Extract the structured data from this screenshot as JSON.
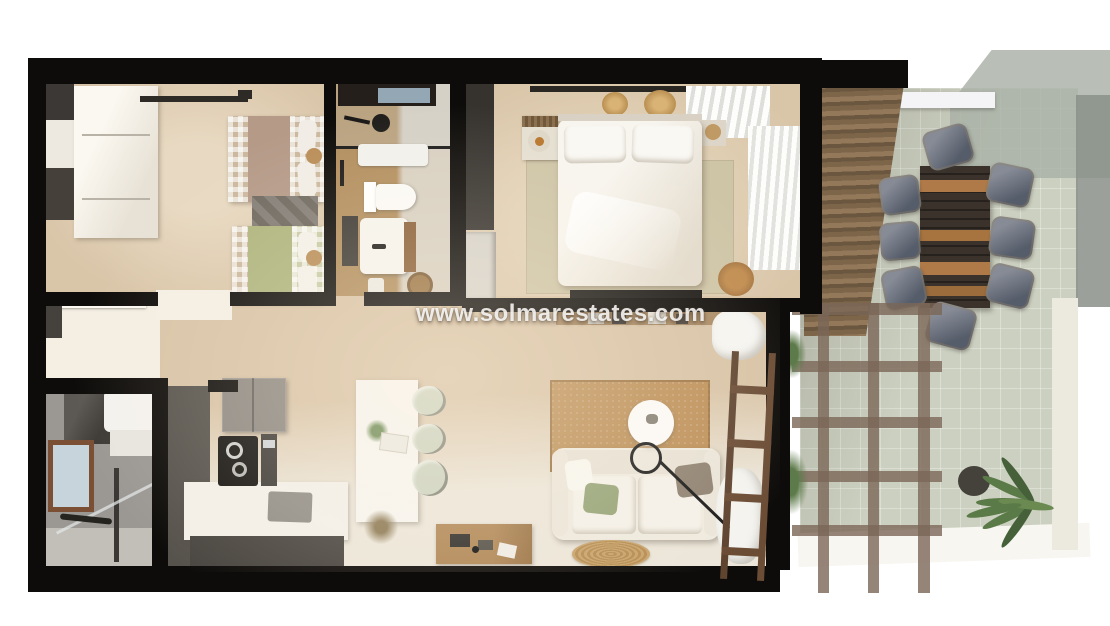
{
  "watermark": {
    "text": "www.solmarestates.com",
    "color": "#ffffff"
  },
  "palette": {
    "wall": "#0e0c0a",
    "floor-beige": "#d9c5a8",
    "floor-light": "#ece6da",
    "floor-wood": "#b28e5e",
    "bath2-tile": "#9b9894",
    "cabinet-dark": "#56524c",
    "wood": "#b07a48",
    "terrace-tile": "#ccd0c0",
    "glass": "#a8afa5",
    "pergola": "#7c685a",
    "chair-cushion": "#565d6a",
    "duvet-green": "#adb47d",
    "jute": "#bd9059",
    "sofa": "#efeadf"
  }
}
